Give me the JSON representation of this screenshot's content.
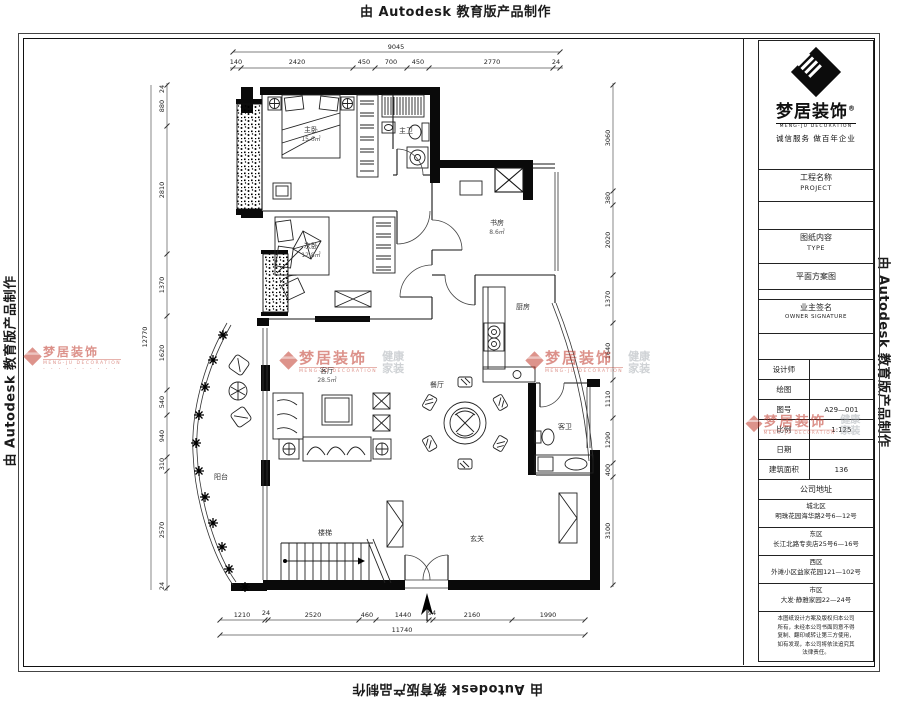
{
  "edge_watermark": "由 Autodesk 教育版产品制作",
  "stamps": {
    "brand": "梦居装饰",
    "sub": "MENG-JU DECORATION",
    "tag1": "健康",
    "tag2": "家装",
    "dots": "· · · · ·  · · · · ·"
  },
  "title_block": {
    "brand": "梦居装饰",
    "reg": "®",
    "brand_en": "MENG-JU DECORATION",
    "tagline": "诚信服务  做百年企业",
    "project_label": "工程名称",
    "project_en": "PROJECT",
    "type_label": "图纸内容",
    "type_en": "TYPE",
    "type_value": "平面方案图",
    "owner_label": "业主签名",
    "owner_en": "OWNER SIGNATURE",
    "fields": [
      {
        "label": "设计师",
        "value": ""
      },
      {
        "label": "绘图",
        "value": ""
      },
      {
        "label": "图号",
        "value": "A29—001"
      },
      {
        "label": "比例",
        "value": "1:125"
      },
      {
        "label": "日期",
        "value": ""
      },
      {
        "label": "建筑面积",
        "value": "136"
      }
    ],
    "address_header": "公司地址",
    "addresses": [
      {
        "l1": "城北区",
        "l2": "明珠花园海华路2号6—12号"
      },
      {
        "l1": "东区",
        "l2": "长江北路专卖店25号6—16号"
      },
      {
        "l1": "西区",
        "l2": "外滩小区益家花园121—102号"
      },
      {
        "l1": "市区",
        "l2": "大发·静雅家园22—24号"
      }
    ],
    "notes": [
      "本图纸设计方案及版权归本公司",
      "所有，未经本公司书面同意不得",
      "复制、翻印或转让第三方使用，",
      "如有发现，本公司将依法追究其",
      "法律责任。"
    ]
  },
  "plan": {
    "labels": {
      "master": {
        "name": "主卧",
        "area": "15.6㎡"
      },
      "master_bath": {
        "name": "主卫",
        "area": ""
      },
      "second": {
        "name": "次卧",
        "area": "12.8㎡"
      },
      "study": {
        "name": "书房",
        "area": "8.6㎡"
      },
      "kitchen": {
        "name": "厨房",
        "area": ""
      },
      "dining": {
        "name": "餐厅",
        "area": ""
      },
      "living": {
        "name": "客厅",
        "area": "28.5㎡"
      },
      "balcony": {
        "name": "阳台",
        "area": ""
      },
      "guest_bath": {
        "name": "客卫",
        "area": ""
      },
      "entry": {
        "name": "玄关",
        "area": ""
      },
      "stair": {
        "name": "楼梯",
        "area": ""
      }
    },
    "dims": {
      "top_total": "9045",
      "top": [
        "140",
        "2420",
        "450",
        "700",
        "450",
        "2770",
        "24"
      ],
      "bottom": [
        "1210",
        "24",
        "2520",
        "460",
        "1440",
        "94",
        "2160",
        "1990"
      ],
      "bottom_total": "11740",
      "left_total": "12770",
      "left": [
        "24",
        "880",
        "2810",
        "1370",
        "1620",
        "540",
        "940",
        "310",
        "2570",
        "24"
      ],
      "right": [
        "3060",
        "380",
        "2020",
        "1370",
        "1640",
        "1110",
        "1290",
        "400",
        "3100"
      ]
    }
  }
}
